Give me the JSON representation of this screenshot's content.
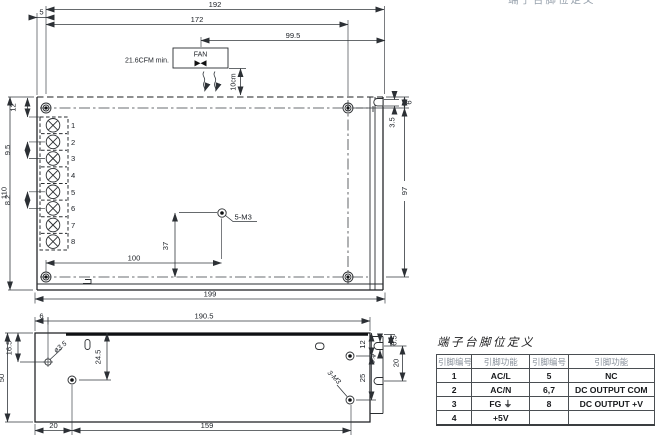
{
  "page": {
    "clipped_header": "端子台脚位定义"
  },
  "top_view": {
    "fan_label": "FAN",
    "airflow_note": "21.6CFM min.",
    "clearance": "10cm",
    "hole_label": "5-M3",
    "terminals": [
      "1",
      "2",
      "3",
      "4",
      "5",
      "6",
      "7",
      "8"
    ],
    "dims": {
      "d192": "192",
      "d172": "172",
      "d99_5": "99.5",
      "d5": "5",
      "d110": "110",
      "d12": "12",
      "d9_5": "9.5",
      "d8_2": "8.2",
      "d6": "6",
      "d3_5": "3.5",
      "d97": "97",
      "d37": "37",
      "d100": "100",
      "d199": "199"
    }
  },
  "bottom_view": {
    "hole_dia_label": "ø3.5",
    "hole_m3_label": "3-M3",
    "dims": {
      "d6": "6",
      "d190_5": "190.5",
      "d16_5": "16.5",
      "d50": "50",
      "d24_5": "24.5",
      "d12": "12",
      "d25": "25",
      "d3_5": "3.5",
      "d6_5": "6.5",
      "d20_right": "20",
      "d20_bottom": "20",
      "d159": "159"
    }
  },
  "pin_table": {
    "title": "端子台脚位定义",
    "headers": [
      "引脚编号",
      "引脚功能",
      "引脚编号",
      "引脚功能"
    ],
    "rows": [
      [
        "1",
        "AC/L",
        "5",
        "NC"
      ],
      [
        "2",
        "AC/N",
        "6,7",
        "DC OUTPUT COM"
      ],
      [
        "3",
        "FG ⏚",
        "8",
        "DC OUTPUT +V"
      ],
      [
        "4",
        "+5V",
        "",
        ""
      ]
    ]
  }
}
